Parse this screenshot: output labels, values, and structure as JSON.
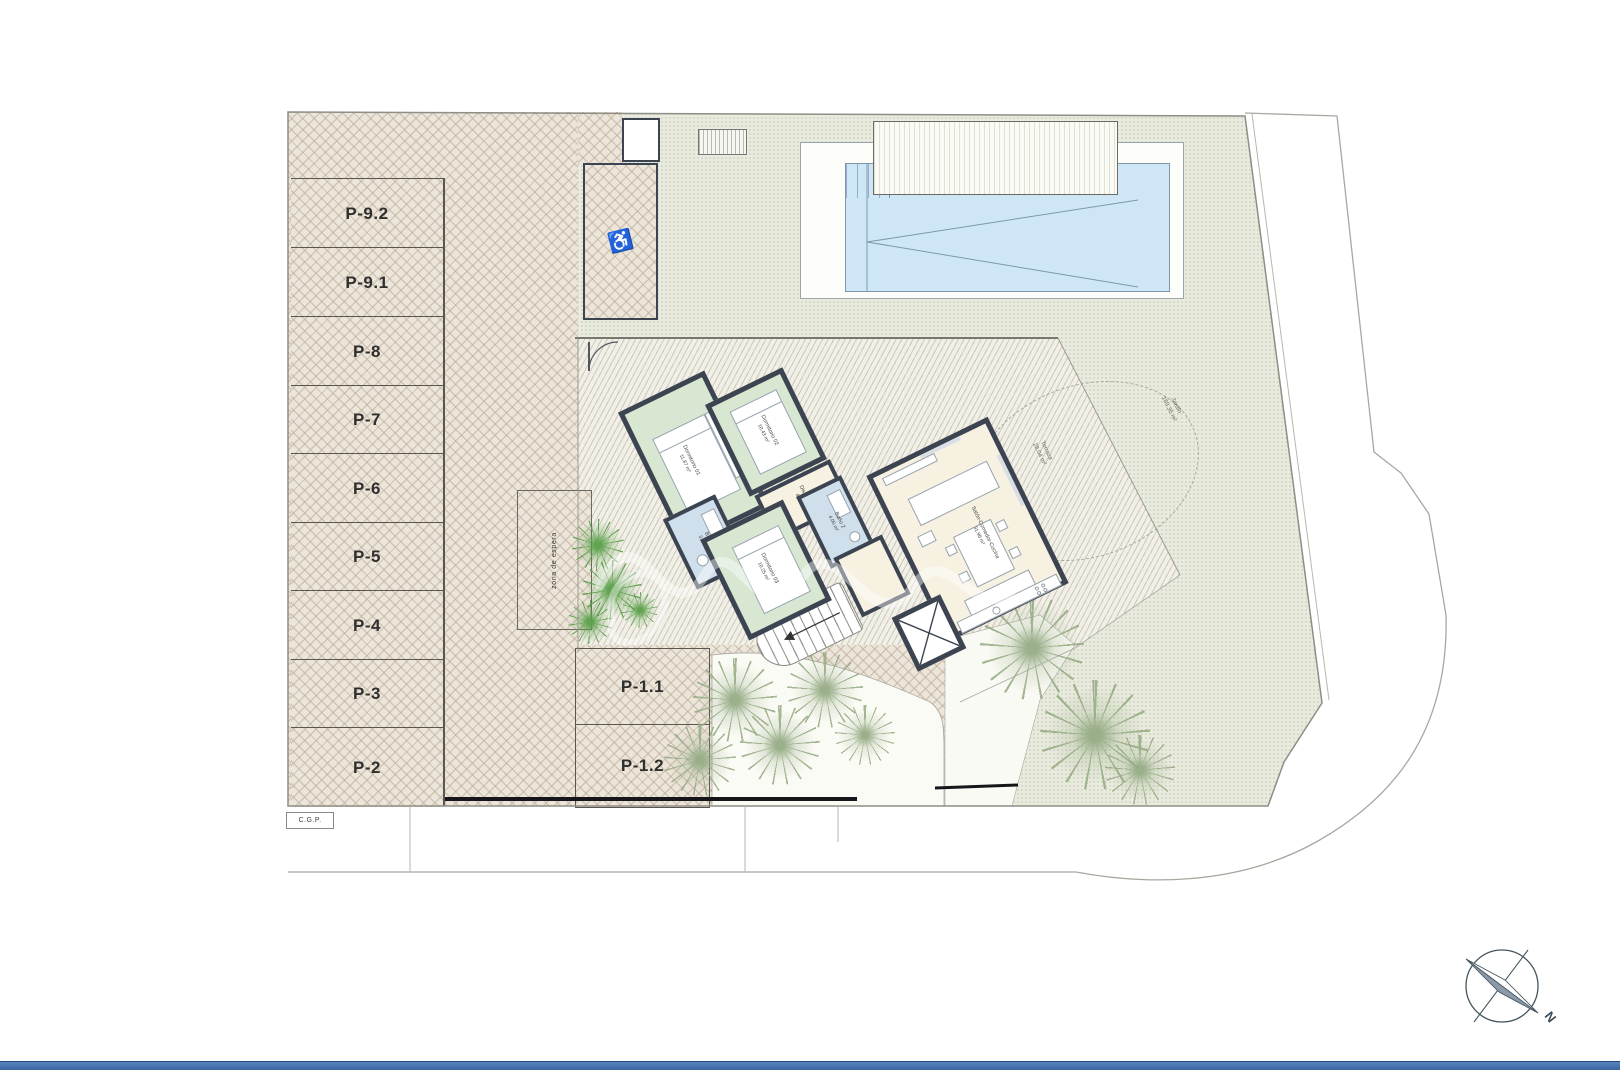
{
  "plan": {
    "title": "site-floor-plan",
    "colors": {
      "wall": "#3d4451",
      "bedroom_fill": "#d7e7d2",
      "bath_fill": "#cfdfec",
      "living_fill": "#f7f1e2",
      "pool_water": "#cfe6f6",
      "paver": "#ece5da",
      "gravel": "#e9ebde",
      "bottom_bar": "#3a659f"
    }
  },
  "parking": {
    "stalls": [
      {
        "label": "P-9.2"
      },
      {
        "label": "P-9.1"
      },
      {
        "label": "P-8"
      },
      {
        "label": "P-7"
      },
      {
        "label": "P-6"
      },
      {
        "label": "P-5"
      },
      {
        "label": "P-4"
      },
      {
        "label": "P-3"
      },
      {
        "label": "P-2"
      }
    ],
    "island_stalls": [
      {
        "label": "P-1.1"
      },
      {
        "label": "P-1.2"
      }
    ],
    "waiting_zone_label": "zona de espera",
    "accessible_icon": "♿"
  },
  "house": {
    "rooms": [
      {
        "name": "Dormitorio 01",
        "area": "11.87 m²"
      },
      {
        "name": "Dormitorio 02",
        "area": "10.43 m²"
      },
      {
        "name": "Dormitorio 03",
        "area": "10.25 m²"
      },
      {
        "name": "Baño 1",
        "area": "3.96 m²"
      },
      {
        "name": "Baño 2",
        "area": "4.05 m²"
      },
      {
        "name": "Distribuidor",
        "area": "4.63 m²"
      },
      {
        "name": "Salón-Comedor-Cocina",
        "area": "31.96 m²"
      }
    ]
  },
  "outdoor": {
    "terrace": {
      "label": "Terraza",
      "area": "28.04 m²"
    },
    "garden": {
      "label": "Jardín",
      "area": "169.35 m²"
    }
  },
  "annotations": {
    "cgp": "C.G.P.",
    "north": "N"
  }
}
